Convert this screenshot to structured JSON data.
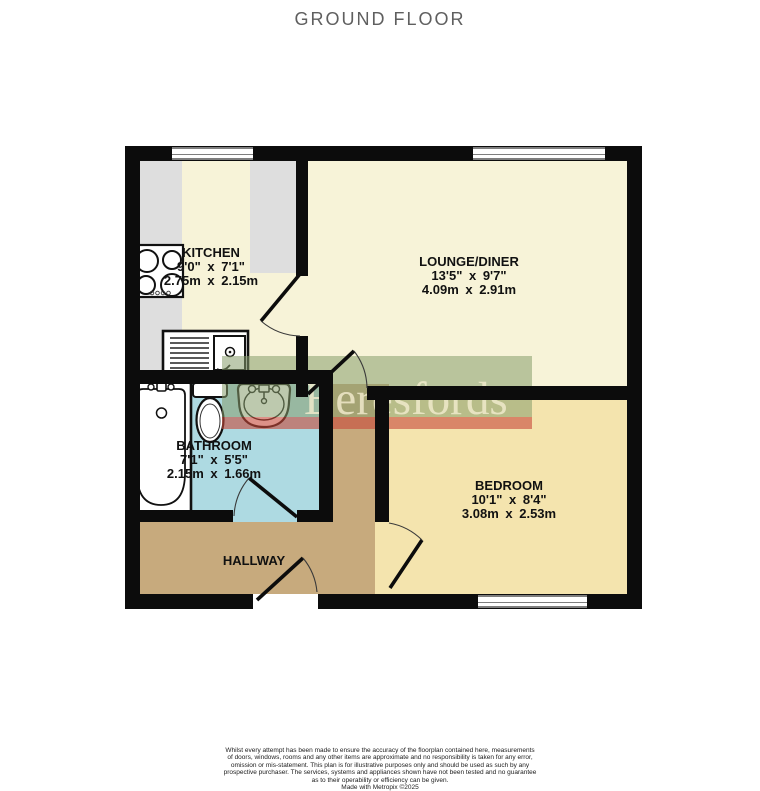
{
  "title": "GROUND FLOOR",
  "watermark": {
    "brand": "Beresfords"
  },
  "rooms": {
    "kitchen": {
      "name": "KITCHEN",
      "imperial": "9'0\"  x 7'1\"",
      "metric": "2.75m  x 2.15m"
    },
    "lounge": {
      "name": "LOUNGE/DINER",
      "imperial": "13'5\"  x 9'7\"",
      "metric": "4.09m  x 2.91m"
    },
    "bathroom": {
      "name": "BATHROOM",
      "imperial": "7'1\"  x 5'5\"",
      "metric": "2.15m  x 1.66m"
    },
    "bedroom": {
      "name": "BEDROOM",
      "imperial": "10'1\"  x 8'4\"",
      "metric": "3.08m  x 2.53m"
    },
    "hallway": {
      "name": "HALLWAY"
    }
  },
  "disclaimer": {
    "lines": [
      "Whilst every attempt has been made to ensure the accuracy of the floorplan contained here, measurements",
      "of doors, windows, rooms and any other items are approximate and no responsibility is taken for any error,",
      "omission or mis-statement. This plan is for illustrative purposes only and should be used as such by any",
      "prospective purchaser. The services, systems and appliances shown have not been tested and no guarantee",
      "as to their operability or efficiency can be given."
    ],
    "credit": "Made with Metropix ©2025"
  },
  "colors": {
    "walls": "#0c0c0c",
    "kitchen_lounge_floor": "#f7f3d8",
    "counter_gray": "#dedede",
    "bathroom_floor": "#aedae2",
    "bedroom_floor": "#f4e4ae",
    "hallway_floor": "#c7aa7d",
    "watermark_green": "#8a9d6b",
    "watermark_red": "#c64838",
    "watermark_text": "#f0e8cc",
    "title_gray": "#5f5f5f"
  }
}
